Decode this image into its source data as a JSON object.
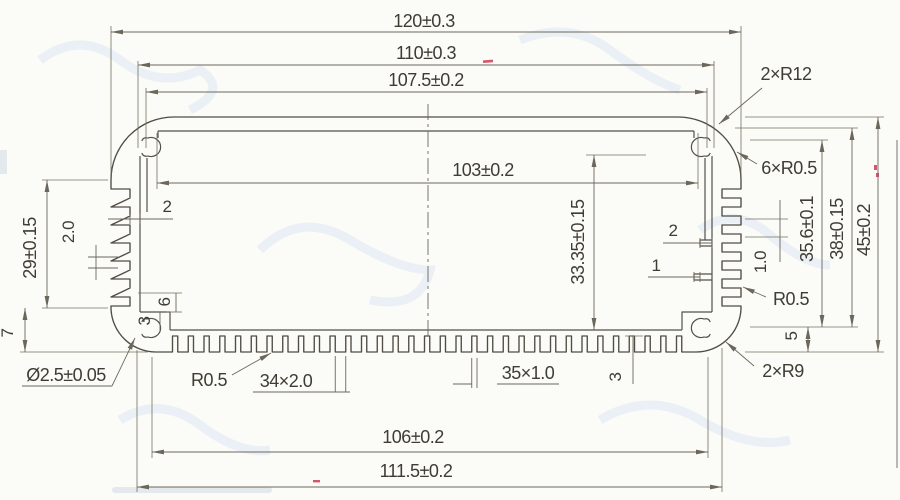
{
  "drawing": {
    "dims": {
      "d120": "120±0.3",
      "d110": "110±0.3",
      "d107_5": "107.5±0.2",
      "d103": "103±0.2",
      "d106": "106±0.2",
      "d111_5": "111.5±0.2",
      "h45": "45±0.2",
      "h38": "38±0.15",
      "h35_6": "35.6±0.1",
      "h33_35": "33.35±0.15",
      "h29": "29±0.15",
      "h7": "7",
      "h5": "5",
      "r12": "2×R12",
      "r05_top": "6×R0.5",
      "r05_right": "R0.5",
      "r9": "2×R9",
      "r05_bottom": "R0.5",
      "hole": "Ø2.5±0.05",
      "fins_bottom_teeth": "34×2.0",
      "fins_bottom_gaps": "35×1.0",
      "wall_2_left": "2",
      "wall_2_right": "2",
      "wall_1_right": "1",
      "gap_1_0": "1.0",
      "fin_2_0": "2.0",
      "step_6_left": "6",
      "step_3_left": "3",
      "base_3": "3"
    }
  }
}
